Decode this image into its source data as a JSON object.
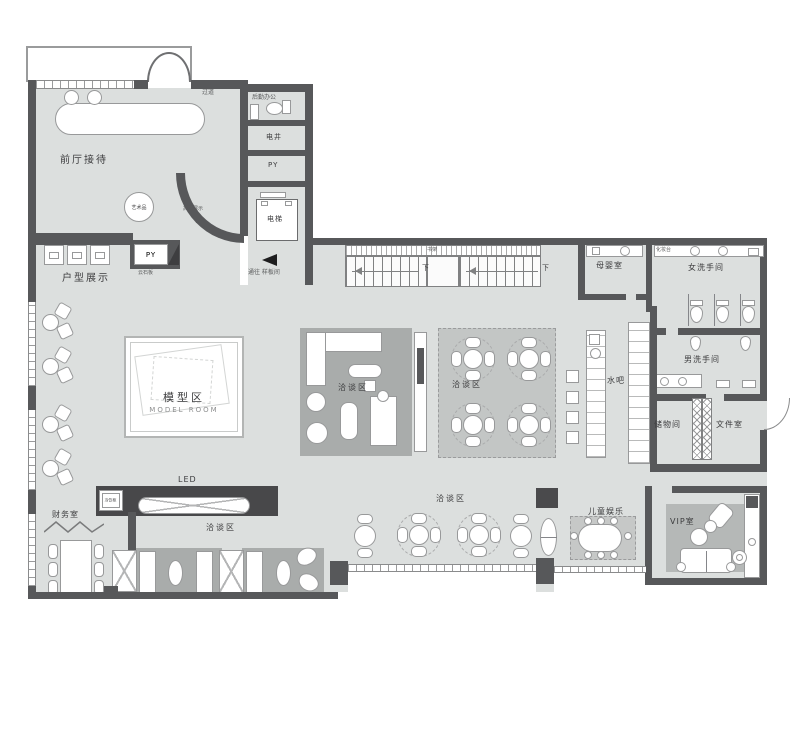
{
  "plan": {
    "type": "floor-plan",
    "language": "zh-CN",
    "areas": {
      "reception_hall": "前厅接待",
      "art_piece": "艺术品",
      "highend_display": "高端展示",
      "unit_display": "户型展示",
      "py": "PY",
      "stone_slab": "云石板",
      "corridor": "过道",
      "back_office": "后勤办公",
      "electrical_shaft": "电井",
      "elevator": "电梯",
      "bookshelf": "书架",
      "mother_baby_room": "母婴室",
      "vanity_counter": "化妆台",
      "women_restroom": "女洗手间",
      "men_restroom": "男洗手间",
      "water_bar": "水吧",
      "storage_room": "储物间",
      "file_room": "文件室",
      "model_area_cn": "模型区",
      "model_area_en": "MODEL ROOM",
      "negotiation_area": "洽谈区",
      "led_screen": "LED",
      "cold_drink_cabinet": "冷饮柜",
      "finance_room": "财务室",
      "kids_play": "儿童娱乐",
      "vip_room": "VIP室"
    },
    "annotations": {
      "down": "下",
      "to_model_rooms": "通往 样板间"
    },
    "colors": {
      "floor": "#dcdfde",
      "wall": "#57585a",
      "rug": "#a9acab",
      "carpet": "#c3c6c5",
      "furniture": "#ffffff",
      "text": "#3c3c3e"
    }
  }
}
